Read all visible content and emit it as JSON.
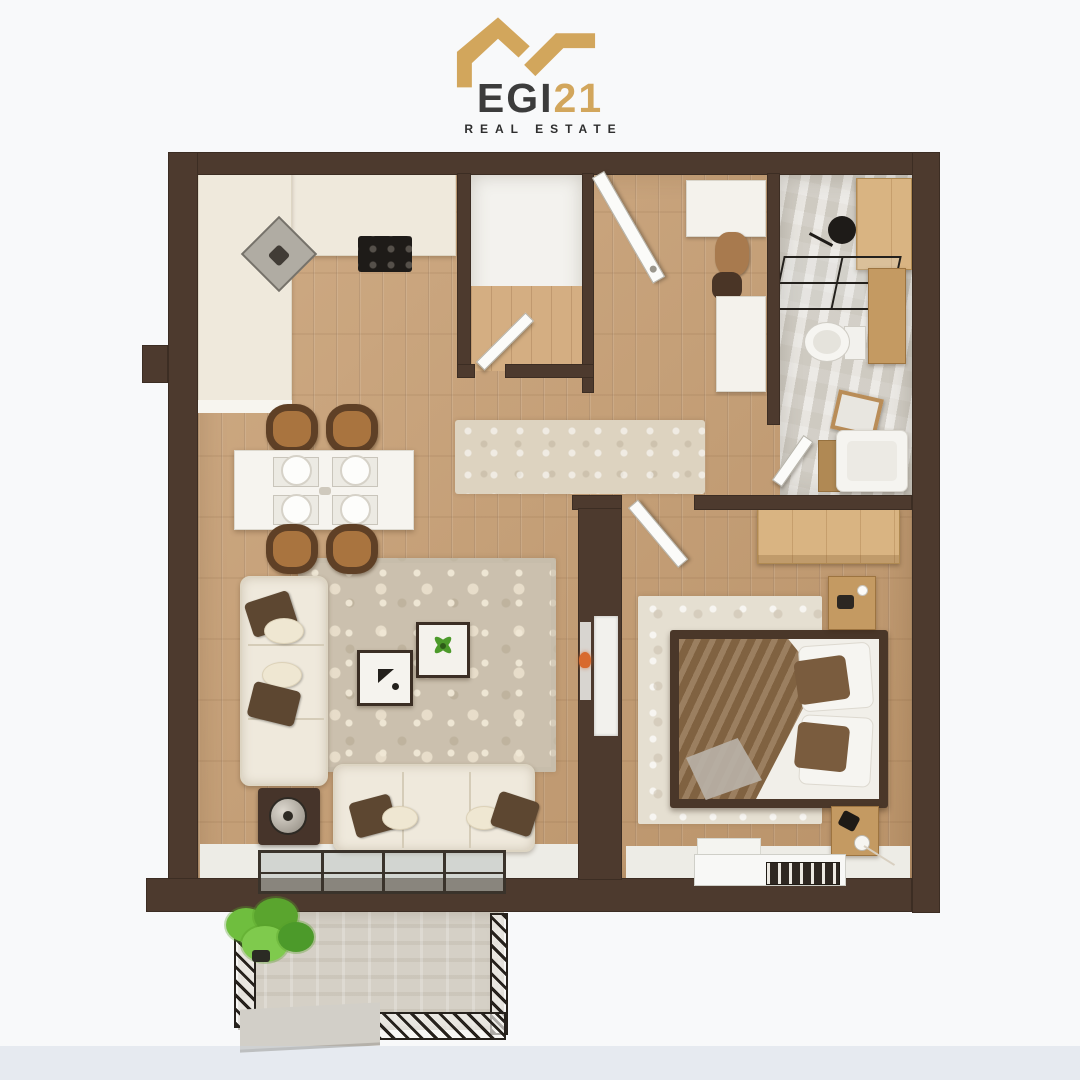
{
  "logo": {
    "brand_left": "EGI",
    "brand_right": "21",
    "subtitle": "REAL ESTATE",
    "icon": "roofline-icon"
  },
  "colors": {
    "background": "#f8f9fa",
    "wall_brown": "#4d3a2e",
    "wood_floor": "#c9a176",
    "ivory_counter_sofa": "#efe9dc",
    "bathroom_marble": "#d8d4cc",
    "balcony_stone": "#d5d0c6",
    "living_rug": "#cbc0ae",
    "bedroom_rug": "#e5dfd1",
    "runner_rug": "#ddd3c0",
    "light_wood_furniture": "#d9b482",
    "bed_frame": "#4a3729",
    "blanket_brown": "#8b6a46",
    "pillow_brown": "#5d4731",
    "plant_green": "#6fbe3e",
    "railing_black": "#26211c",
    "logo_gold": "#d2a65c",
    "logo_text_dark": "#3c3c3c"
  },
  "scene": {
    "type": "3d-floor-plan-top-view",
    "rooms": [
      "kitchen",
      "dining-area",
      "living-room",
      "hallway",
      "walk-in-closet",
      "bathroom",
      "bedroom",
      "balcony"
    ],
    "furniture_icons": [
      "kitchen-counter",
      "corner-sink",
      "cooktop",
      "dining-table",
      "dining-chair",
      "runner-rug",
      "living-rug",
      "sofa",
      "side-table-lamp",
      "coffee-table",
      "decor-plant",
      "fireplace-niche",
      "entrance-door",
      "closet-door",
      "bathroom-door",
      "bedroom-door",
      "shower-head",
      "shower-glass",
      "shower-bench",
      "toilet",
      "washbasin",
      "leaning-mirror",
      "bathroom-cabinet",
      "hall-cabinet",
      "hall-console",
      "wardrobe",
      "double-bed",
      "nightstand",
      "window-radiator",
      "balcony-railing",
      "balcony-plant",
      "balcony-bench",
      "sliding-glass-door"
    ]
  }
}
